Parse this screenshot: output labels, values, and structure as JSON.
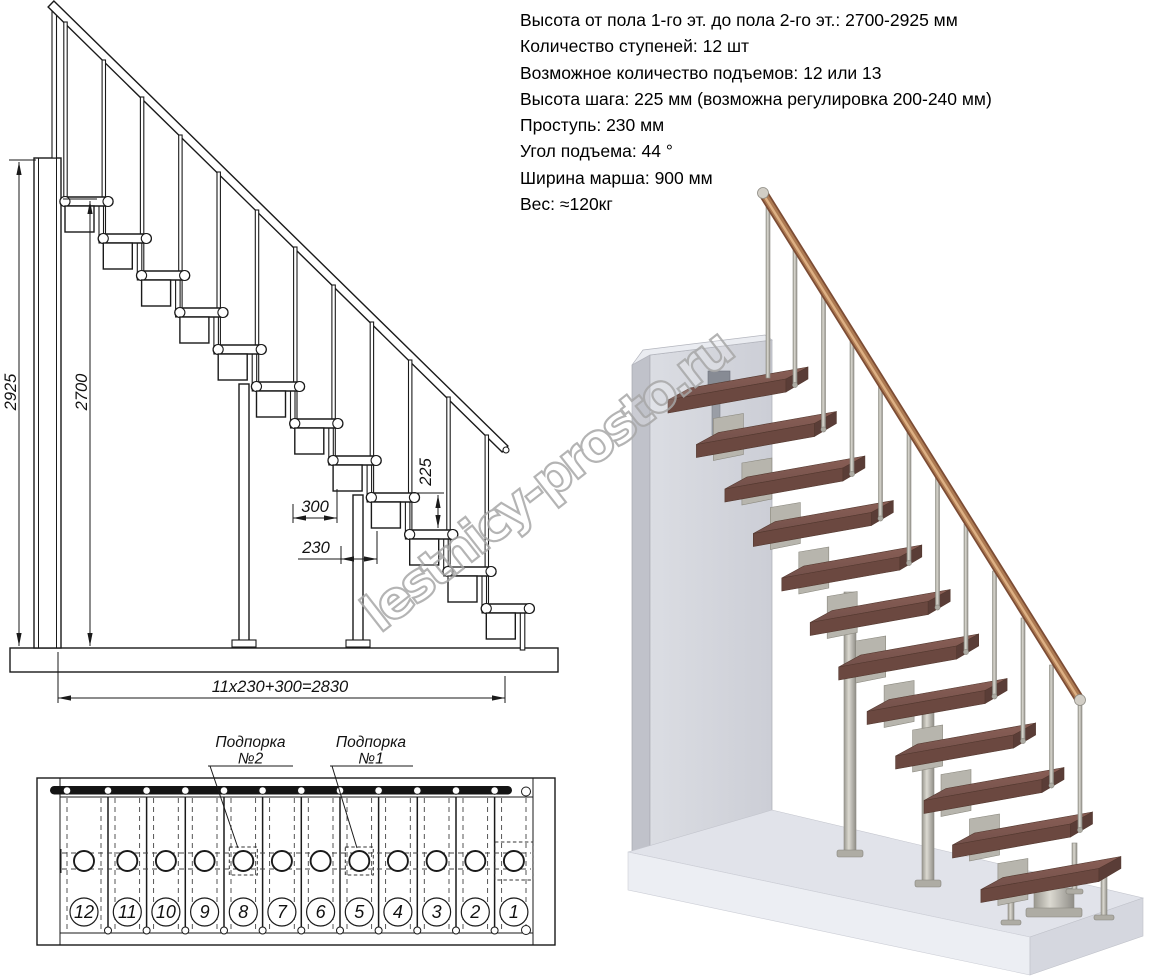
{
  "specs": {
    "lines": [
      "Высота от пола 1-го эт. до пола 2-го эт.: 2700-2925 мм",
      "Количество ступеней: 12 шт",
      "Возможное количество подъемов: 12 или 13",
      "Высота шага: 225 мм (возможна регулировка 200-240 мм)",
      "Проступь: 230 мм",
      "Угол подъема: 44 °",
      "Ширина марша: 900 мм",
      "Вес: ≈120кг"
    ]
  },
  "side_view": {
    "dim_total_height": "2925",
    "dim_clear_height": "2700",
    "dim_tread_depth": "300",
    "dim_run": "230",
    "dim_rise": "225",
    "dim_total_run": "11x230+300=2830"
  },
  "plan_view": {
    "support2_line1": "Подпорка",
    "support2_line2": "№2",
    "support1_line1": "Подпорка",
    "support1_line2": "№1",
    "steps": [
      {
        "number": "12"
      },
      {
        "number": "11"
      },
      {
        "number": "10"
      },
      {
        "number": "9"
      },
      {
        "number": "8"
      },
      {
        "number": "7"
      },
      {
        "number": "6"
      },
      {
        "number": "5"
      },
      {
        "number": "4"
      },
      {
        "number": "3"
      },
      {
        "number": "2"
      },
      {
        "number": "1"
      }
    ]
  },
  "watermark": {
    "text": "lestnicy-prosto.ru"
  },
  "colors": {
    "line": "#1a1a1a",
    "tread_wood": "#7d574f",
    "handrail_wood": "#ad7a52",
    "metal": "#c6c4bc",
    "wall": "#d6d8de",
    "floor": "#e2e4eb",
    "watermark_gray": "#a8a8a8"
  }
}
